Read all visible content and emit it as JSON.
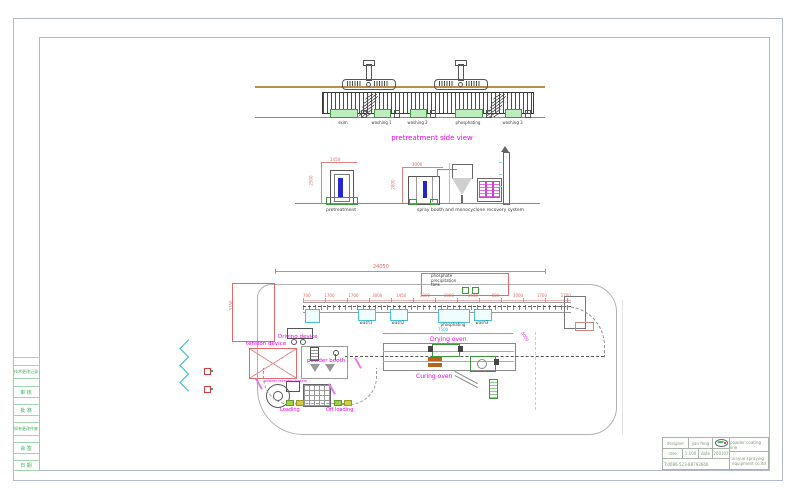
{
  "side_strip": {
    "rows": [
      "",
      "技术更改记录",
      "",
      "审 核",
      "",
      "批 准",
      "",
      "如有更改作废",
      "",
      "会 签",
      "",
      "日 期"
    ]
  },
  "title_block": {
    "designer_label": "designer",
    "designer_value": "jian feng",
    "rate_label": "rate",
    "rate_value": "1:100",
    "date_label": "date",
    "date_value": "200107",
    "phone": "T:0086-523-88793666",
    "product": "powder coating line",
    "company_line1": "xinyue spraying",
    "company_line2": "equipment co.ltd"
  },
  "side_view": {
    "title": "pretreatment side view",
    "stations": [
      "skim",
      "washing 1",
      "washing 2",
      "phosphating",
      "washing 3"
    ]
  },
  "elevation": {
    "left_label": "pretreatment",
    "right_label": "spray booth and monocyclone recovery system",
    "dims": {
      "left_h": "2500",
      "left_w": "1450",
      "booth_h": "2800",
      "booth_w": "3000"
    }
  },
  "plan": {
    "dims": {
      "total": "24050",
      "oven": "7500",
      "curve_right": "5000",
      "left_v": "3350",
      "ticks": [
        "700",
        "1700",
        "1700",
        "3000",
        "1450",
        "3000",
        "3000",
        "1445",
        "600",
        "3000",
        "1700",
        "1700"
      ]
    },
    "labels": {
      "phosphate_line1": "phosphate",
      "phosphate_line2": "precipitation",
      "phosphate_line3": "tank",
      "driving": "Driving device",
      "tension": "tension device",
      "booth": "powder booth",
      "recovery": "powder recovery system",
      "loading": "Loading",
      "off_loading": "Off loading",
      "drying": "Drying oven",
      "curing": "Curing oven",
      "wash1": "wash1",
      "wash2": "wash2",
      "phosphating": "phosphating",
      "wash3": "wash3",
      "dots": "· · ·"
    }
  },
  "colors": {
    "magenta": "#e800e8",
    "dim_red": "#e06a6a",
    "green": "#3cb060",
    "cyan": "#2ab8c8",
    "beam_tan": "#b5924c",
    "work_blue": "#2626cc"
  }
}
